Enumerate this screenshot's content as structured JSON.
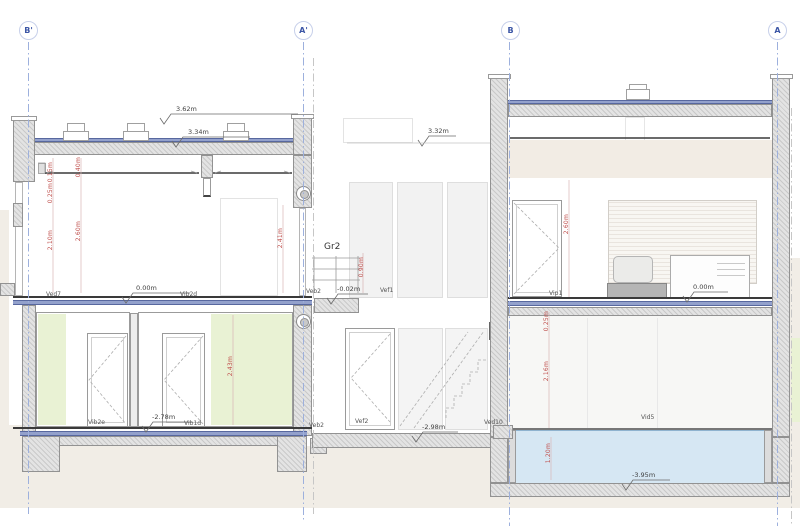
{
  "section_markers": {
    "b_prime": "B'",
    "a_prime": "A'",
    "b": "B",
    "a": "A"
  },
  "levels": {
    "roof_top": "3.62m",
    "roof_low": "3.34m",
    "mid_roof": "3.32m",
    "gf_left": "0.00m",
    "entry": "-0.02m",
    "gf_right": "0.00m",
    "basement_left": "-2.78m",
    "stair_bottom": "-2.98m",
    "pool_bottom": "-3.95m"
  },
  "tags": {
    "ved7": "Ved7",
    "vib2d": "Vib2d",
    "veb2_gf": "Veb2",
    "vef1": "Vef1",
    "gr2": "Gr2",
    "vip1": "Vip1",
    "vib2e": "Vib2e",
    "vib1d": "Vib1d",
    "veb2_lf": "Veb2",
    "vef2": "Vef2",
    "ved10": "Ved10",
    "vid5": "Vid5"
  },
  "dims": {
    "d015": "0.15m",
    "d040": "0.40m",
    "d025": "0.25m",
    "d210": "2.10m",
    "d260": "2.60m",
    "d241": "2.41m",
    "d090": "0.90m",
    "d243": "2.43m",
    "d260r": "2.60m",
    "d025r": "0.25m",
    "d216r": "2.16m",
    "d120r": "1.20m"
  },
  "colors": {
    "section_line": "#9db0dd",
    "slab_blue": "#93a1cc",
    "dim_red": "#c0504d",
    "wall_green": "#e9f2d4",
    "water": "#d6e7f3",
    "ground": "#f1ede6"
  }
}
